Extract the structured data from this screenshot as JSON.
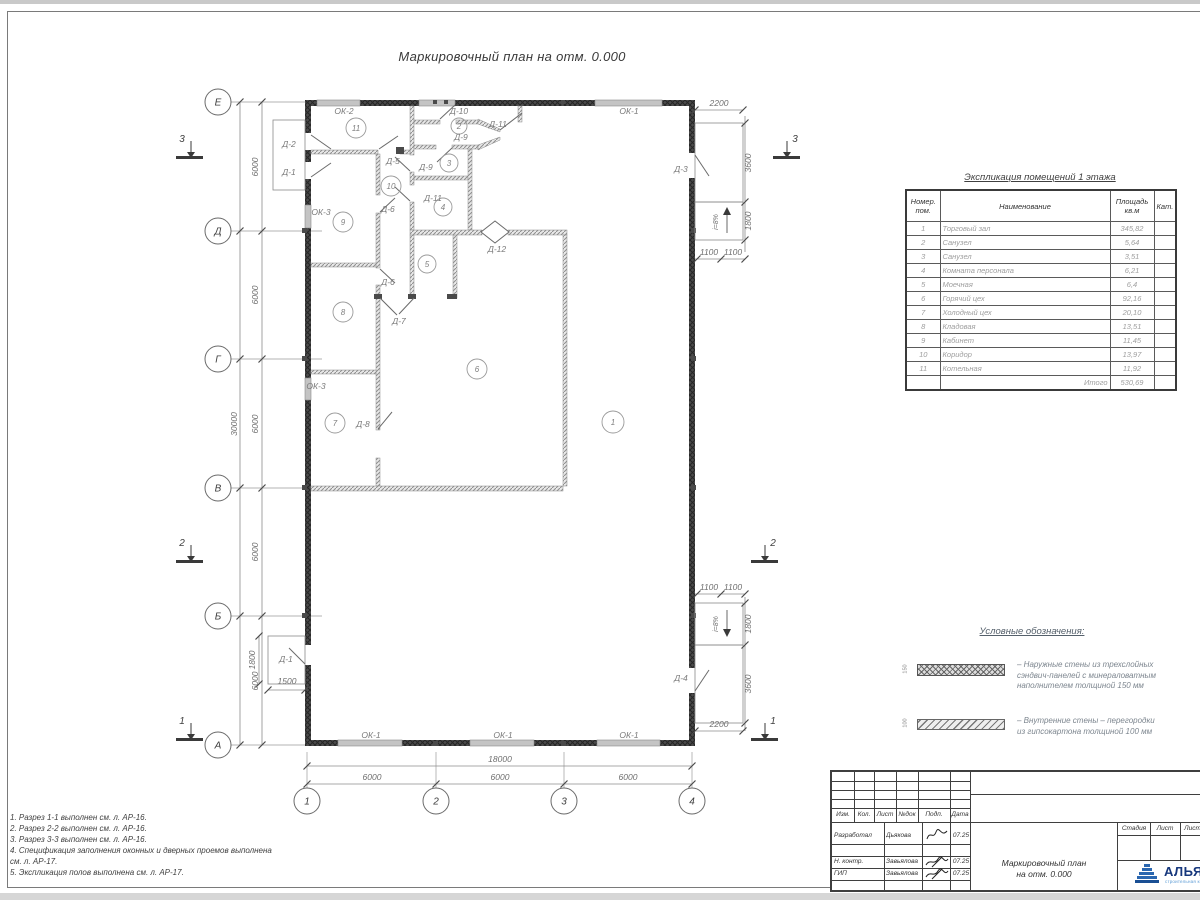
{
  "sheet": {
    "title": "Маркировочный план на отм. 0.000"
  },
  "plan": {
    "grid_rows": [
      "Е",
      "Д",
      "Г",
      "В",
      "Б",
      "А"
    ],
    "grid_cols": [
      "1",
      "2",
      "3",
      "4"
    ],
    "rooms": [
      "1",
      "2",
      "3",
      "4",
      "5",
      "6",
      "7",
      "8",
      "9",
      "10",
      "11"
    ],
    "sections": [
      "1",
      "2",
      "3"
    ],
    "dims": {
      "total_v": "30000",
      "v": [
        "6000",
        "6000",
        "6000",
        "6000",
        "6000"
      ],
      "total_h": "18000",
      "h": [
        "6000",
        "6000",
        "6000"
      ],
      "rt": [
        "2200",
        "3600",
        "1800",
        "1100",
        "1100"
      ],
      "rb": [
        "1100",
        "1100",
        "1800",
        "3600",
        "2200"
      ],
      "porch": [
        "1800",
        "1500"
      ],
      "ramp": "i=8%"
    },
    "labels": {
      "d1a": "Д-1",
      "d1b": "Д-1",
      "d2": "Д-2",
      "d3": "Д-3",
      "d4": "Д-4",
      "d5": "Д-5",
      "d6a": "Д-6",
      "d6b": "Д-6",
      "d7": "Д-7",
      "d8": "Д-8",
      "d9a": "Д-9",
      "d9b": "Д-9",
      "d10": "Д-10",
      "d11a": "Д-11",
      "d11b": "Д-11",
      "d12": "Д-12",
      "ok1t": "ОК-1",
      "ok1b1": "ОК-1",
      "ok1b2": "ОК-1",
      "ok1b3": "ОК-1",
      "ok2": "ОК-2",
      "ok3a": "ОК-3",
      "ok3b": "ОК-3"
    }
  },
  "explication": {
    "title": "Экспликация помещений 1 этажа",
    "headers": {
      "num1": "Номер.",
      "num2": "пом.",
      "name": "Наименование",
      "area1": "Площадь",
      "area2": "кв.м",
      "cat": "Кат."
    },
    "rows": [
      {
        "num": "1",
        "name": "Торговый зал",
        "area": "345,82",
        "cat": ""
      },
      {
        "num": "2",
        "name": "Санузел",
        "area": "5,64",
        "cat": ""
      },
      {
        "num": "3",
        "name": "Санузел",
        "area": "3,51",
        "cat": ""
      },
      {
        "num": "4",
        "name": "Комната персонала",
        "area": "6,21",
        "cat": ""
      },
      {
        "num": "5",
        "name": "Моечная",
        "area": "6,4",
        "cat": ""
      },
      {
        "num": "6",
        "name": "Горячий цех",
        "area": "92,16",
        "cat": ""
      },
      {
        "num": "7",
        "name": "Холодный цех",
        "area": "20,10",
        "cat": ""
      },
      {
        "num": "8",
        "name": "Кладовая",
        "area": "13,51",
        "cat": ""
      },
      {
        "num": "9",
        "name": "Кабинет",
        "area": "11,45",
        "cat": ""
      },
      {
        "num": "10",
        "name": "Коридор",
        "area": "13,97",
        "cat": ""
      },
      {
        "num": "11",
        "name": "Котельная",
        "area": "11,92",
        "cat": ""
      }
    ],
    "total_label": "Итого",
    "total": "530,69"
  },
  "legend": {
    "title": "Условные обозначения:",
    "items": [
      {
        "dim": "150",
        "lines": [
          "– Наружные стены из трехслойных",
          "сэндвич-панелей с минераловатным",
          "наполнителем толщиной 150 мм"
        ]
      },
      {
        "dim": "100",
        "lines": [
          "– Внутренние стены – перегородки",
          "из гипсокартона толщиной 100 мм"
        ]
      }
    ]
  },
  "notes": [
    "1. Разрез 1-1 выполнен см. л. АР-16.",
    "2. Разрез 2-2 выполнен см. л. АР-16.",
    "3. Разрез 3-3 выполнен см. л. АР-16.",
    "4. Спецификация заполнения оконных и дверных проемов выполнена",
    "см. л. АР-17.",
    "5. Экспликация полов выполнена см. л. АР-17."
  ],
  "titleblock": {
    "header_cols": [
      "Изм.",
      "Кол.",
      "Лист",
      "№док",
      "Подп.",
      "Дата"
    ],
    "rows": [
      {
        "role": "Разработал",
        "name": "Дьякова",
        "date": "07.25"
      },
      {
        "role": "Н. контр.",
        "name": "Завьялова",
        "date": "07.25"
      },
      {
        "role": "ГИП",
        "name": "Завьялова",
        "date": "07.25"
      }
    ],
    "stage_cols": [
      "Стадия",
      "Лист",
      "Листов"
    ],
    "doc_title_1": "Маркировочный план",
    "doc_title_2": "на отм. 0.000",
    "logo_text": "АЛЬЯНС",
    "logo_sub": "строительная компания"
  }
}
